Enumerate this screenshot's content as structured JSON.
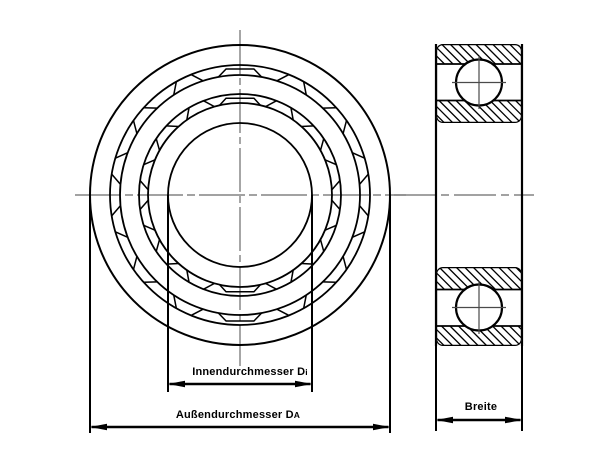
{
  "dimensions": {
    "inner_diameter": {
      "label": "Innendurchmesser D",
      "subscript": "i"
    },
    "outer_diameter": {
      "label": "Außendurchmesser D",
      "subscript": "A"
    },
    "width": {
      "label": "Breite"
    }
  },
  "colors": {
    "ink": "#000000",
    "centerline": "#6b6b6b",
    "background": "#ffffff"
  }
}
